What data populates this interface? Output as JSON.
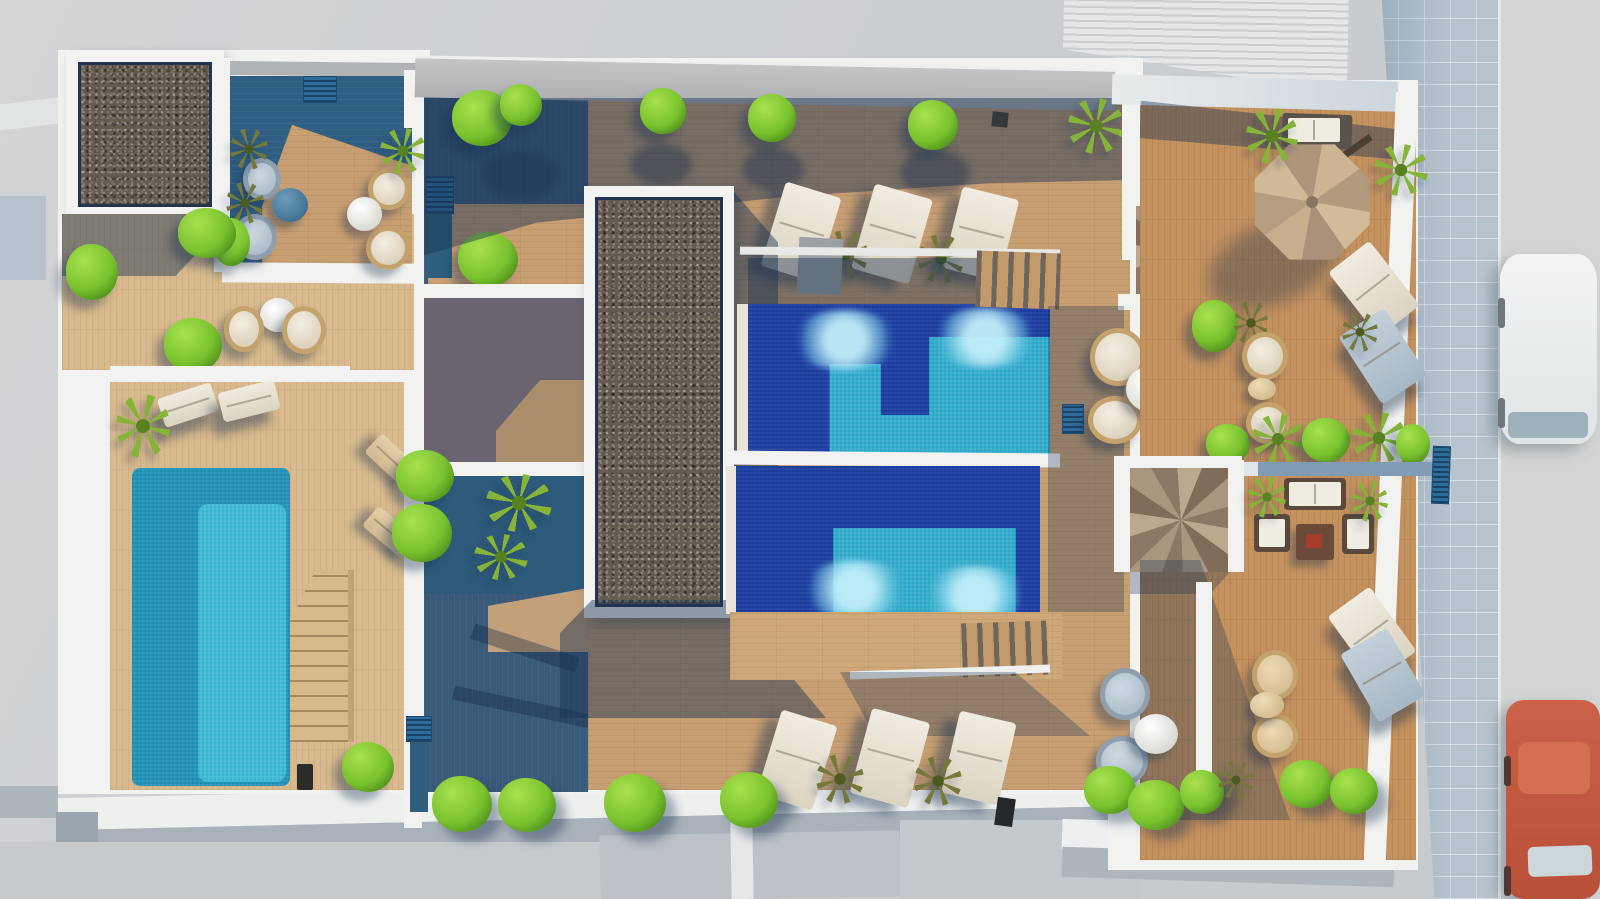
{
  "scene": {
    "description": "Aerial top-down 3D architectural rendering of a residential rooftop terrace complex with swimming pools, wooden sun decks, gravel beds, lounge furniture, spiral staircases, a cantilever umbrella, and a street with two parked cars",
    "view": "top-down aerial",
    "lighting": "late afternoon sun casting long blue shadows toward lower-left",
    "visible_text": "none"
  },
  "palette": {
    "background_concrete": "#cdd0d2",
    "sidewalk_tile": "#b8c4cd",
    "street": "#d3d5d4",
    "parapet_white": "#f2f3f1",
    "roof_band_gray": "#b6b8ba",
    "deck_wood_sunlit": "#c89f73",
    "deck_wood_pale": "#d8ba8e",
    "deck_wood_warm": "#c4925f",
    "deck_shadow_blue": "#33597c",
    "gravel_dark": "#635a50",
    "planter_gap_navy": "#23354e",
    "pool_deep_blue": "#1d3fa4",
    "pool_turquoise": "#33afd0",
    "pool_glow_cyan": "#a5e2f0",
    "private_pool_teal": "#2196ba",
    "private_pool_light": "#41bdda",
    "bush_green": "#79c22e",
    "palm_olive": "#86b437",
    "umbrella_beige": "#c4ad8e",
    "cushion_white": "#efe9dc",
    "rattan_tan": "#c4a26c",
    "stair_taupe": "#a8967f",
    "car_white": "#ebeeee",
    "car_red": "#c3573d",
    "blue_grate": "#2e6c99"
  },
  "regions": {
    "left_wing": "Private terrace with turquoise pool, two sun loungers, wooden stairs and gravel planter",
    "center_block": "Communal deck with long gravel bed and two deep-blue pools with turquoise shelves",
    "right_wing": "Lounge terraces with cantilever umbrella, two spiral staircases, sofa set and hanging chairs",
    "surroundings": "Tiled sidewalk and street with a white car and a red car, neighboring slatted roof"
  },
  "inventory": {
    "pools": [
      {
        "id": "main-pool-upper",
        "water": "deep blue with turquoise shallow shelf and two light jets"
      },
      {
        "id": "main-pool-lower",
        "water": "deep blue with turquoise shallow band and two light jets"
      },
      {
        "id": "private-pool-left",
        "water": "two-tone turquoise"
      }
    ],
    "gravel_beds": 2,
    "spiral_staircases": 2,
    "cantilever_umbrellas": 1,
    "sun_loungers": 14,
    "hanging_rattan_chairs": 12,
    "round_side_tables": 7,
    "sofa_sets": 1,
    "ball_bushes": 18,
    "palm_plants": 14,
    "blue_vent_grates": 4,
    "parked_cars": [
      "white",
      "red"
    ]
  }
}
